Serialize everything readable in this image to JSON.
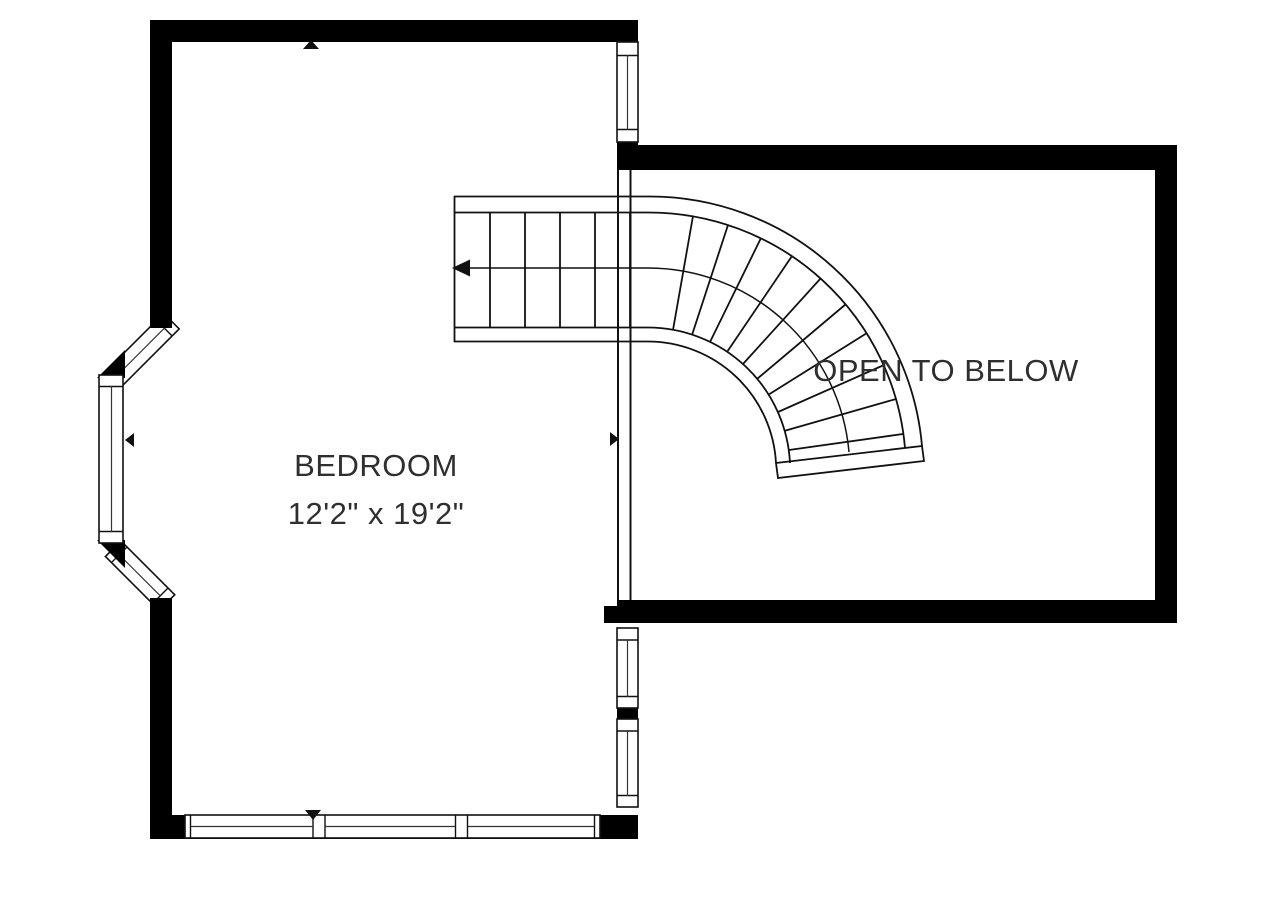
{
  "floorplan": {
    "bedroom": {
      "name": "BEDROOM",
      "dimensions": "12'2\" x 19'2\""
    },
    "open_area": {
      "name": "OPEN TO BELOW"
    },
    "colors": {
      "walls": "#000000",
      "lines": "#111111",
      "text": "#2f2f2f",
      "background": "#ffffff"
    },
    "icons": [
      "stair-direction-arrow",
      "dimension-arrow-up",
      "dimension-arrow-down",
      "dimension-arrow-left",
      "dimension-arrow-right"
    ]
  }
}
